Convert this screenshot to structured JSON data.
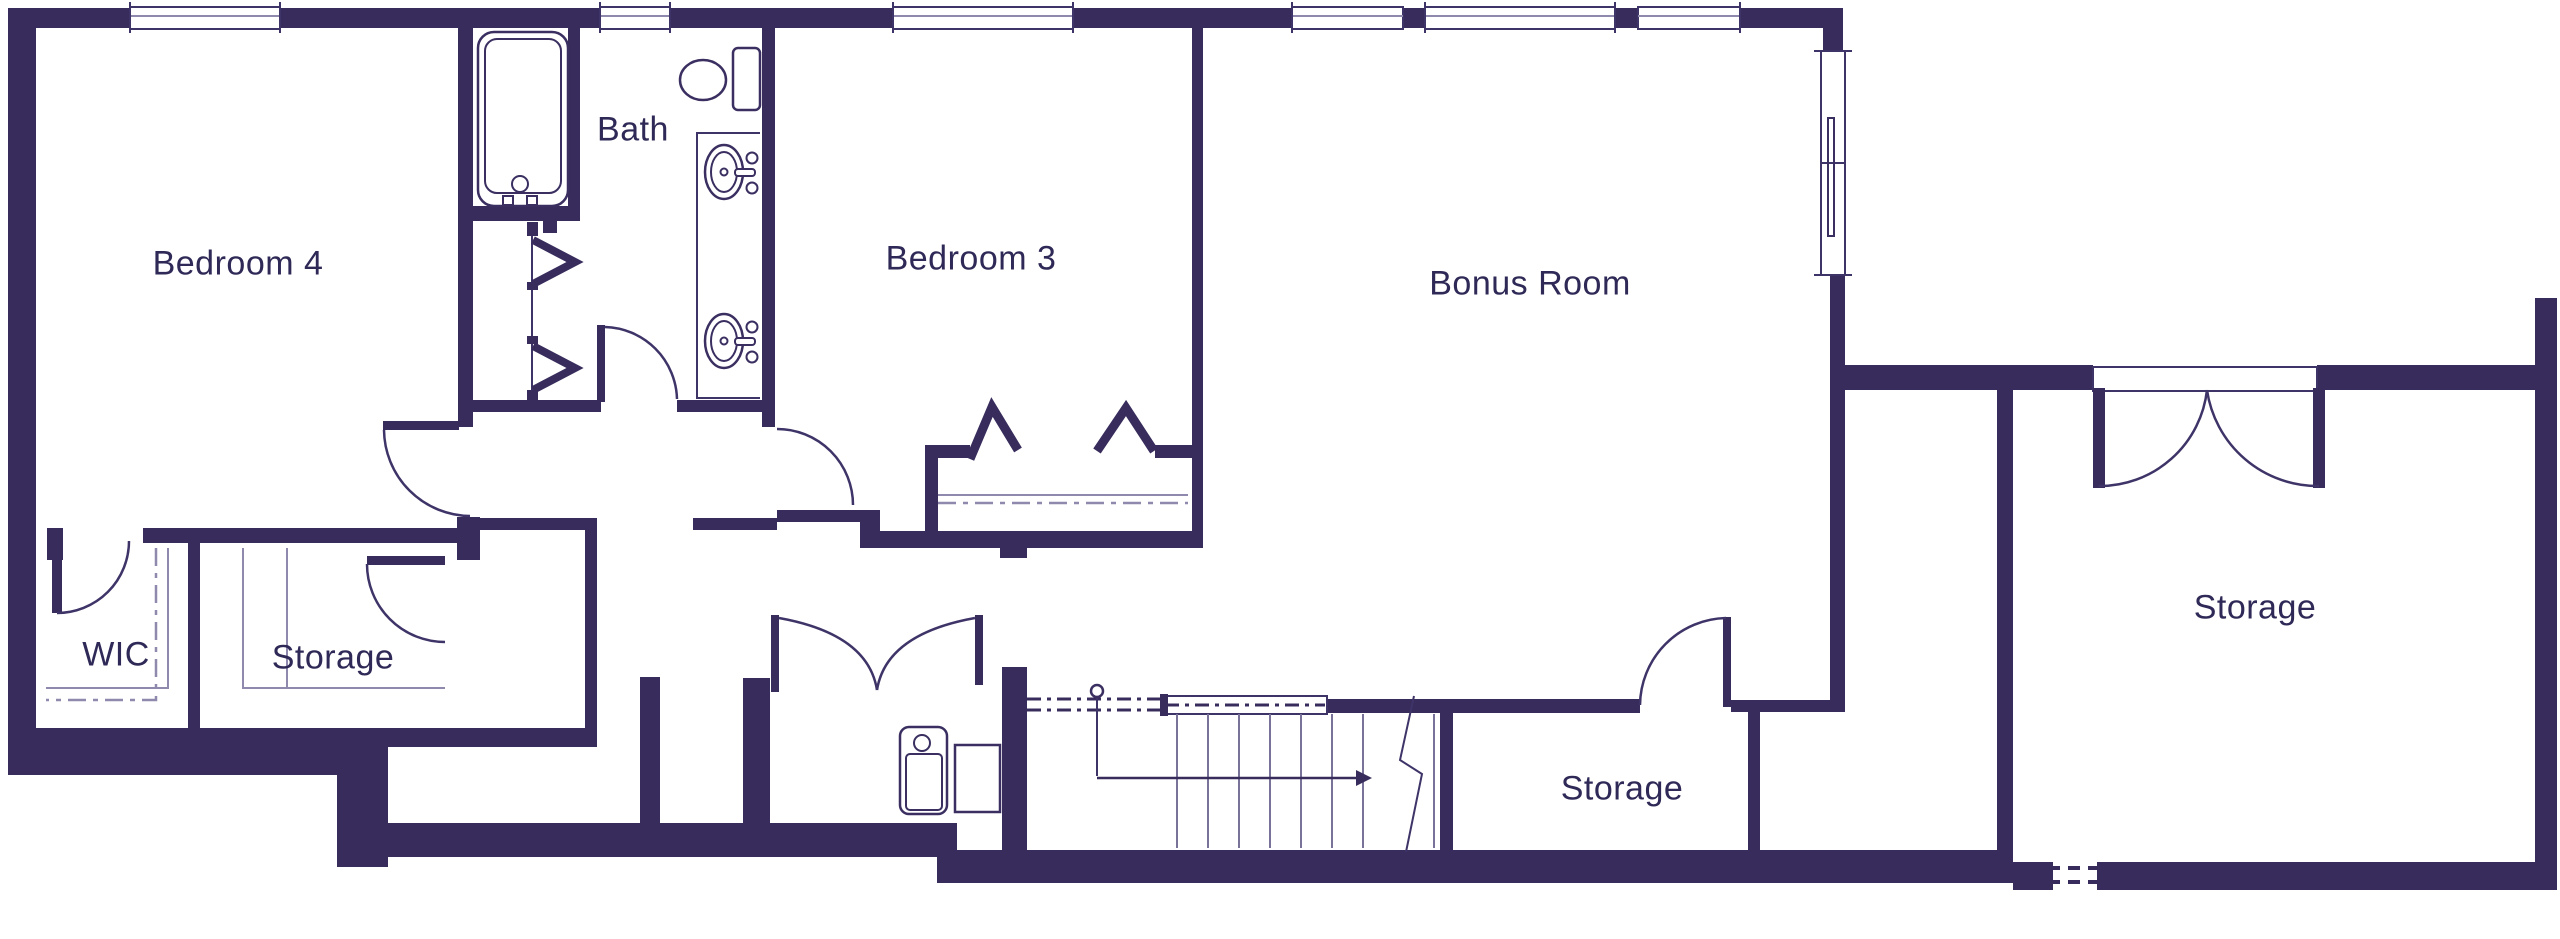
{
  "plan_title": "Upper floor plan",
  "rooms": [
    {
      "label": "Bedroom 4"
    },
    {
      "label": "Bath"
    },
    {
      "label": "Bedroom 3"
    },
    {
      "label": "Bonus Room"
    },
    {
      "label": "WIC"
    },
    {
      "label": "Storage"
    },
    {
      "label": "Storage"
    },
    {
      "label": "Storage"
    }
  ],
  "stairs": {
    "direction": "down-right"
  },
  "fixtures": [
    "bathtub",
    "toilet",
    "vanity-sink",
    "vanity-sink",
    "water-heater",
    "utility-unit"
  ],
  "colors": {
    "wall": "#382c5c",
    "background": "#ffffff",
    "label_text": "#2e2956",
    "thin_line": "#3f3468",
    "light_line": "#8f89ad",
    "fixture_line": "#3a2f60",
    "tread_line": "#7a7399"
  }
}
